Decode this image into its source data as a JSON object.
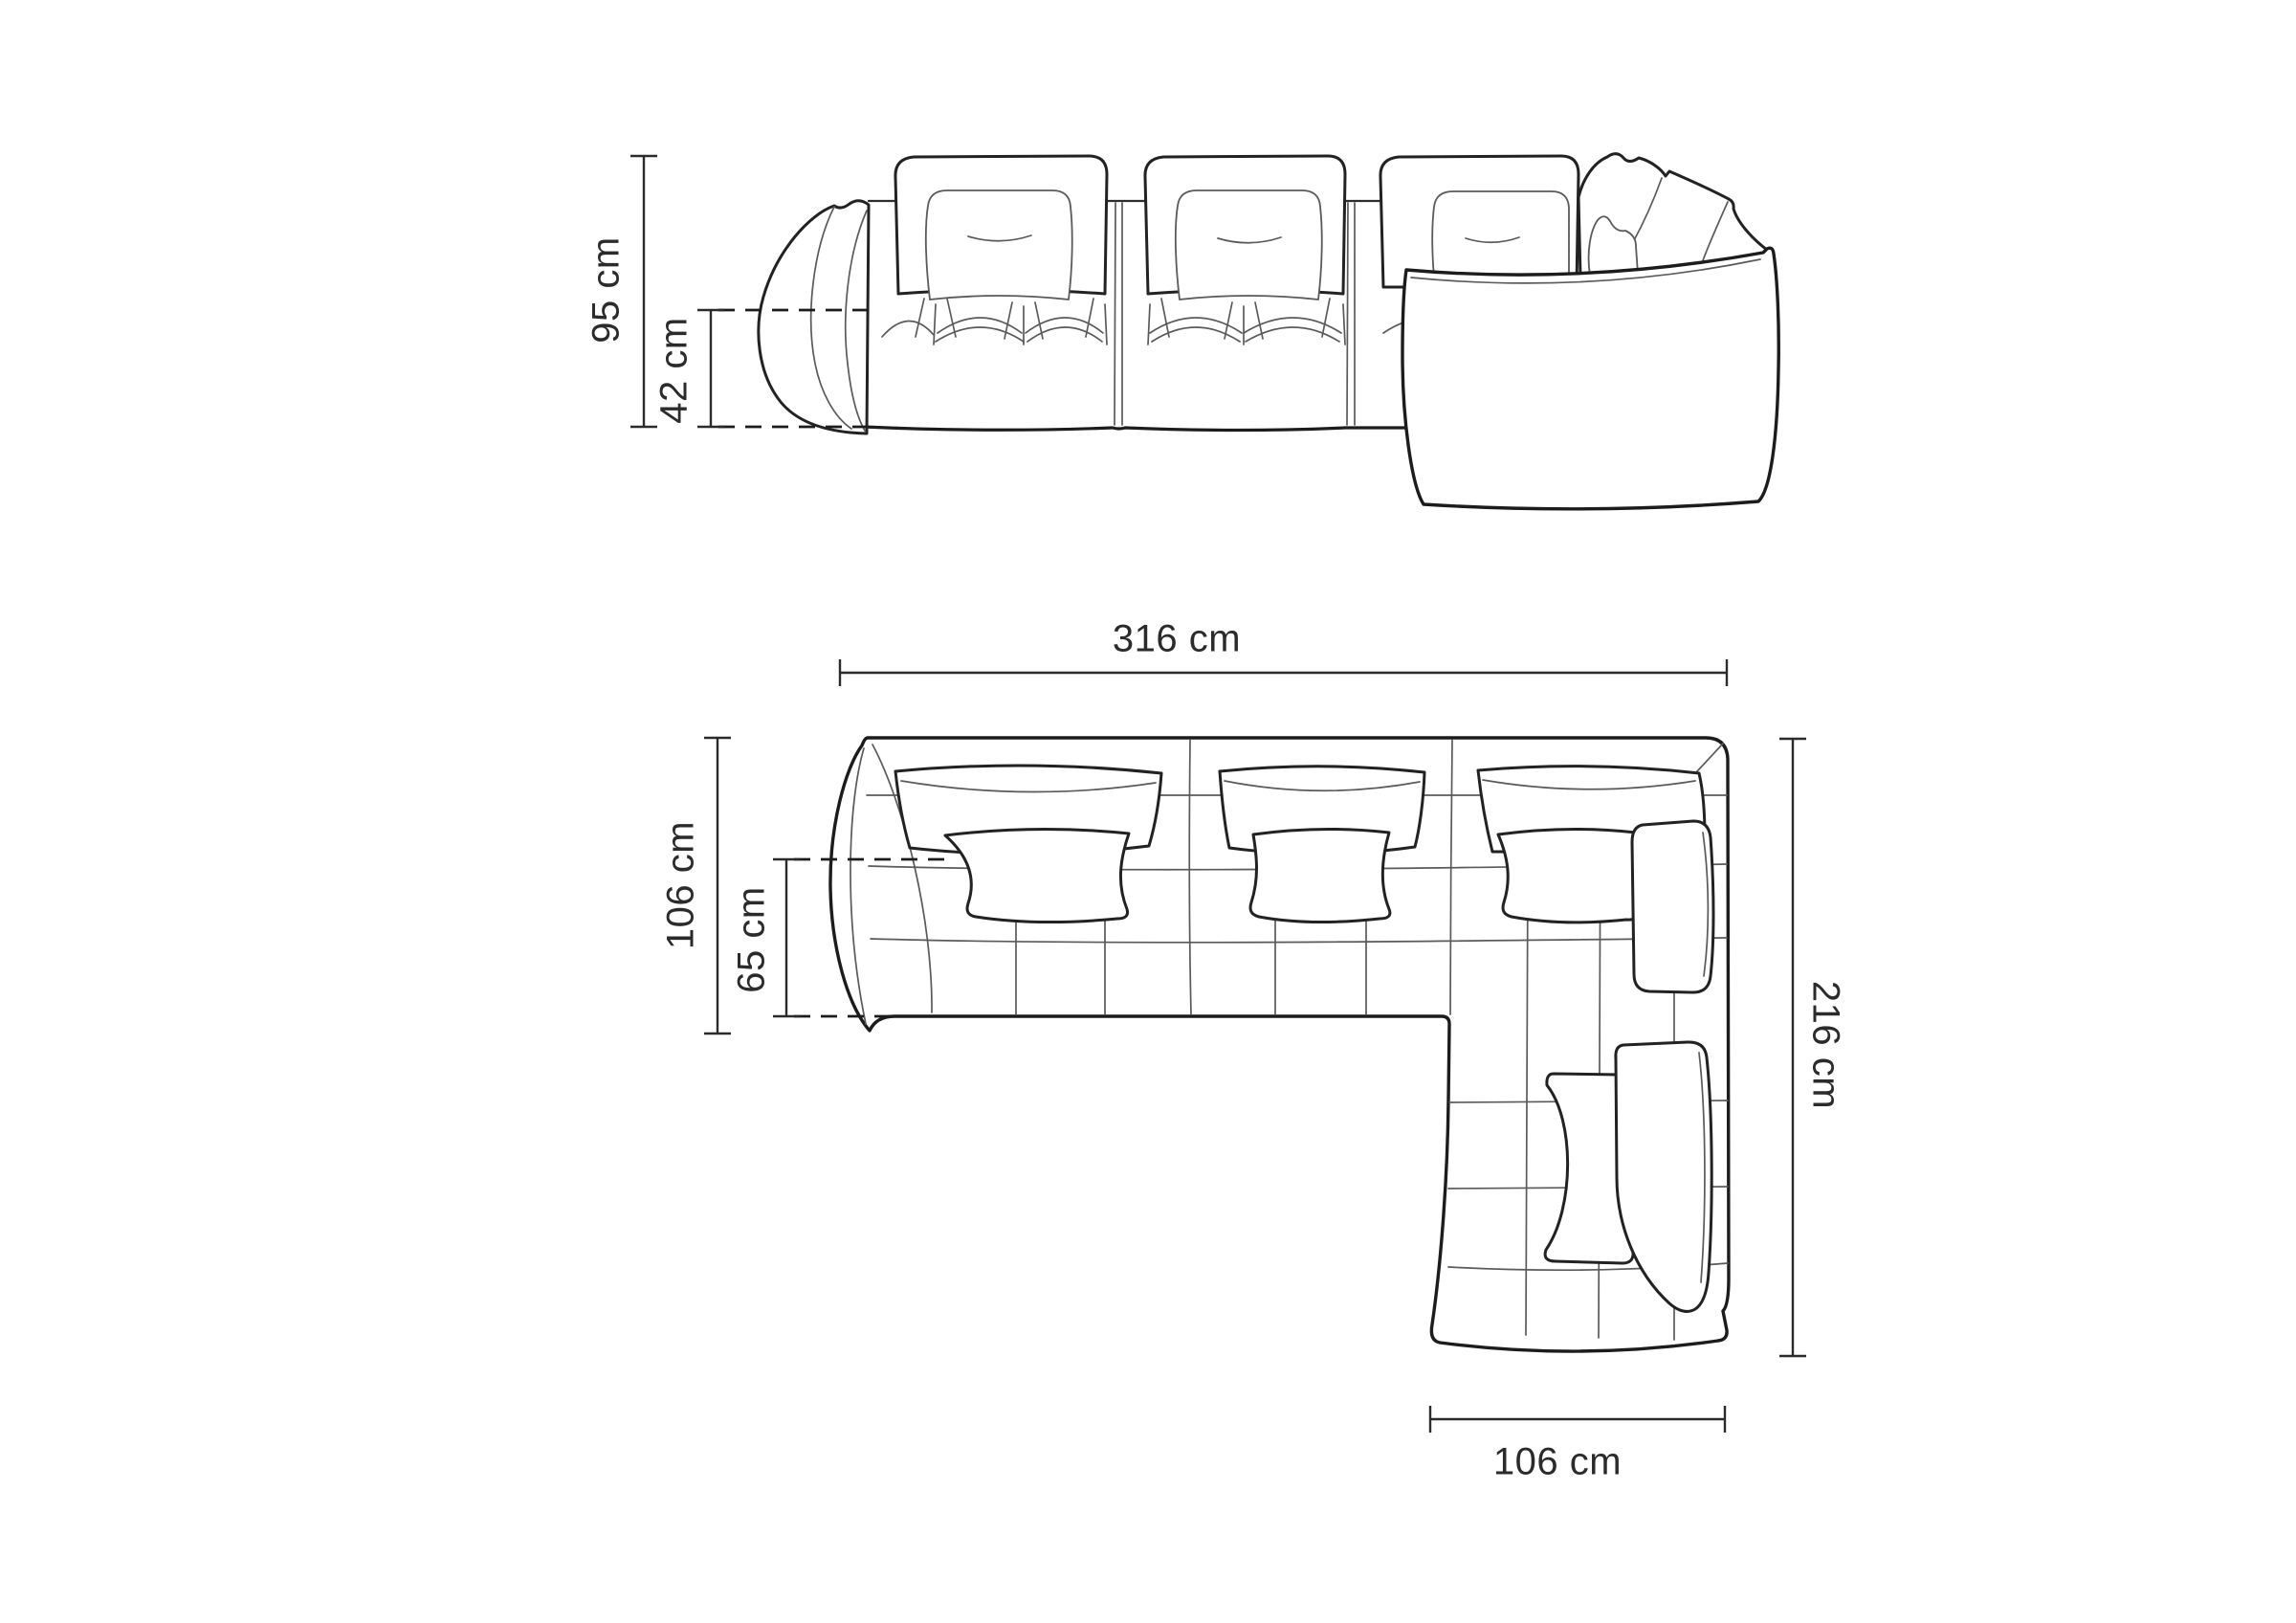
{
  "colors": {
    "background": "#ffffff",
    "outline": "#1c1c1c",
    "detail_line": "#5a5a5a",
    "dimension": "#2b2b2b"
  },
  "views": {
    "front_elevation": {
      "dimensions": {
        "overall_height": "95 cm",
        "seat_height": "42 cm"
      }
    },
    "top_plan": {
      "dimensions": {
        "overall_width": "316 cm",
        "module_depth": "106 cm",
        "seat_depth": "65 cm",
        "overall_depth": "216 cm",
        "chaise_width": "106 cm"
      }
    }
  }
}
